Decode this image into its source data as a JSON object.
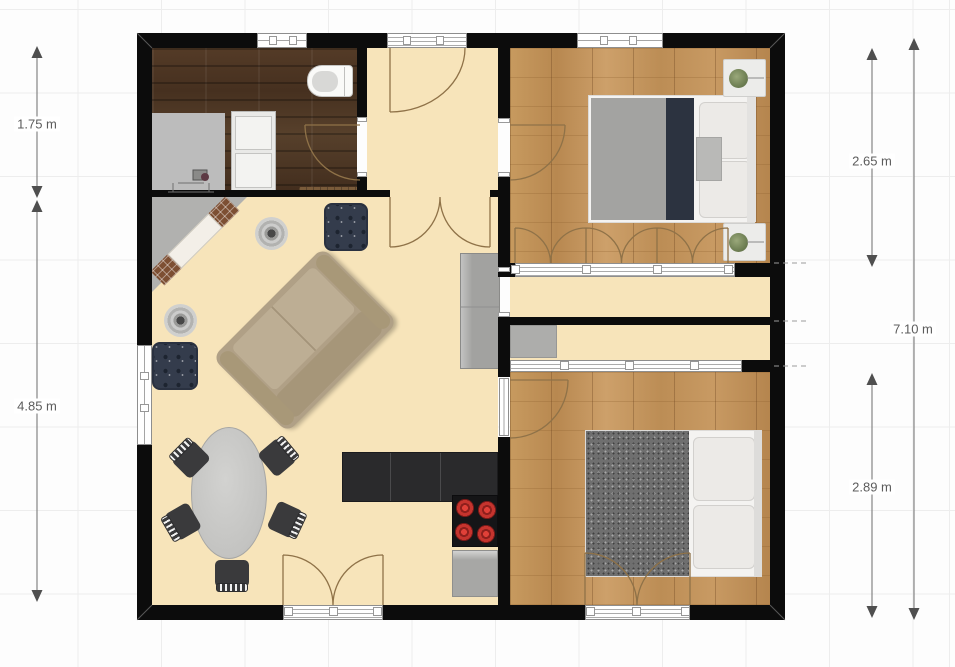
{
  "view": {
    "type": "2d-floor-plan",
    "grid_cell_meters": 1
  },
  "dimensions": {
    "left": [
      {
        "label": "1.75 m"
      },
      {
        "label": "4.85 m"
      }
    ],
    "right": [
      {
        "label": "2.65 m"
      },
      {
        "label": "2.89 m"
      },
      {
        "label": "7.10 m"
      }
    ]
  },
  "colors": {
    "wall": "#0c0c0c",
    "floor_cream": "#f7e4ba",
    "floor_wood_light": "#c09154",
    "floor_wood_dark": "#4c3523",
    "grid_line": "#ededed",
    "dimension_text": "#5c5c5c",
    "burner_red": "#c5342e",
    "ottoman_navy": "#343c4c"
  },
  "objects": [
    {
      "name": "toilet"
    },
    {
      "name": "desk-with-chair"
    },
    {
      "name": "storage-cabinet"
    },
    {
      "name": "bench"
    },
    {
      "name": "double-bed",
      "count": 2
    },
    {
      "name": "nightstand-with-plant",
      "count": 2
    },
    {
      "name": "closet-folding-doors"
    },
    {
      "name": "sliding-wardrobe"
    },
    {
      "name": "appliance-niche"
    },
    {
      "name": "corner-fireplace"
    },
    {
      "name": "sofa"
    },
    {
      "name": "ottoman",
      "count": 2
    },
    {
      "name": "round-side-table",
      "count": 2
    },
    {
      "name": "oval-dining-table"
    },
    {
      "name": "dining-chair",
      "count": 5
    },
    {
      "name": "kitchen-counter"
    },
    {
      "name": "cooktop"
    },
    {
      "name": "dishwasher"
    },
    {
      "name": "sideboard"
    }
  ]
}
